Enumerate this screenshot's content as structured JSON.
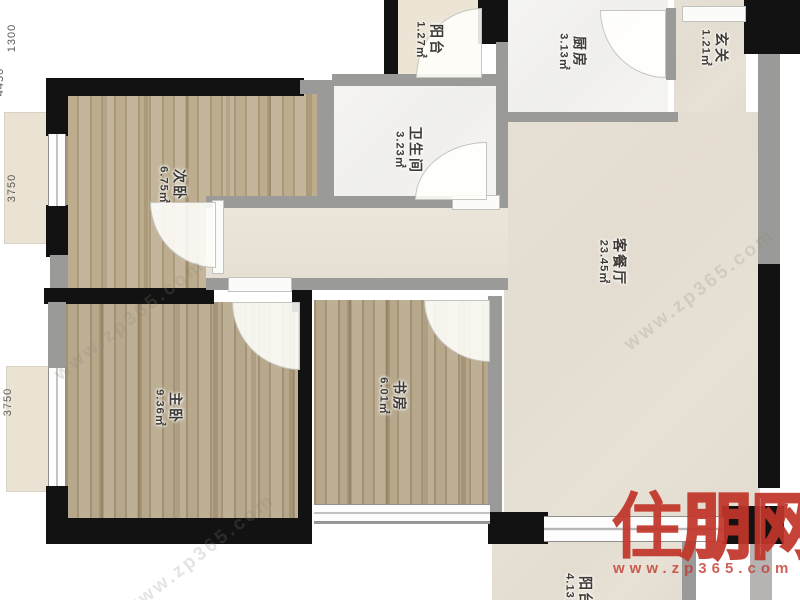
{
  "rooms": [
    {
      "id": "balcony-top",
      "name": "阳台",
      "area": "1.27㎡"
    },
    {
      "id": "kitchen",
      "name": "厨房",
      "area": "3.13㎡"
    },
    {
      "id": "foyer",
      "name": "玄关",
      "area": "1.21㎡"
    },
    {
      "id": "bathroom",
      "name": "卫生间",
      "area": "3.23㎡"
    },
    {
      "id": "bedroom-second",
      "name": "次卧",
      "area": "6.75㎡"
    },
    {
      "id": "living-dining",
      "name": "客餐厅",
      "area": "23.45㎡"
    },
    {
      "id": "bedroom-master",
      "name": "主卧",
      "area": "9.36㎡"
    },
    {
      "id": "study",
      "name": "书房",
      "area": "6.01㎡"
    },
    {
      "id": "balcony-bottom",
      "name": "阳台",
      "area": "4.13㎡"
    }
  ],
  "dimensions": [
    "1300",
    "4450",
    "3750",
    "3750"
  ],
  "watermark": {
    "site_name_chars": [
      "住",
      "朋",
      "网"
    ],
    "site_url": "www.zp365.com"
  },
  "colors": {
    "wall_exterior": "#121212",
    "wall_interior": "#9a9a98",
    "wood_floor": "#b5a483",
    "living_floor": "#e5ded2",
    "watermark_red": "#c1352a"
  }
}
